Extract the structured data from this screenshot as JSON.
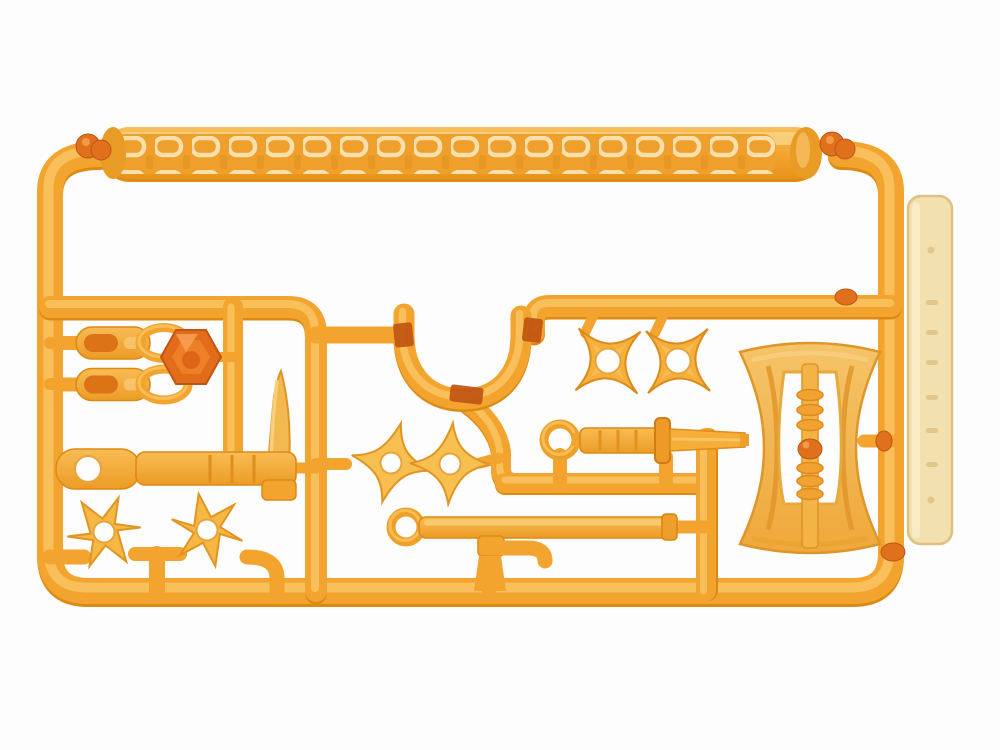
{
  "image": {
    "type": "product-photo",
    "subject": "Injection-molded plastic model runner (sprue) of ninja weapon accessories in translucent orange plastic",
    "orientation": "landscape"
  },
  "labels": {
    "figure": "Translucent orange plastic model kit runner with ninja weapon parts: chain, shuriken stars, sword, sickle, scabbard and a large double-bladed axe"
  },
  "colors": {
    "background": "#fdfdfd",
    "plastic_base": "#F2A42E",
    "plastic_light": "#F9C462",
    "plastic_shadow": "#DD8A14",
    "plastic_deep": "#C05514",
    "gate_knob": "#E0701C",
    "chain_link": "#F8DFAC",
    "chain_lane": "#EE9F2C",
    "part_translucent": "#F3B951",
    "hexagon": "#E36C1A",
    "tag_fill": "#F2E0AE",
    "tag_edge": "#DFC083"
  },
  "parts": [
    {
      "id": "chain-strip",
      "name": "weapon chain",
      "count": 1,
      "position": "top bar of runner"
    },
    {
      "id": "belt-clip",
      "name": "belt clip with oval loop",
      "count": 2,
      "position": "upper left"
    },
    {
      "id": "hex-connector",
      "name": "hexagonal connector gem",
      "count": 1,
      "position": "upper left"
    },
    {
      "id": "kama-sickle",
      "name": "kama sickle with upward blade and ring handle",
      "count": 1,
      "position": "middle left"
    },
    {
      "id": "u-piece",
      "name": "U-shaped curved piece with dark gate bands",
      "count": 1,
      "position": "center"
    },
    {
      "id": "pinwheel-shuriken",
      "name": "four-point pinwheel shuriken",
      "count": 2,
      "position": "center"
    },
    {
      "id": "square-shuriken",
      "name": "square four-point shuriken",
      "count": 2,
      "position": "upper center-right"
    },
    {
      "id": "six-point-shuriken",
      "name": "six-point star shuriken",
      "count": 2,
      "position": "lower left"
    },
    {
      "id": "ring-sword",
      "name": "straight sword with ring pommel and square guard",
      "count": 1,
      "position": "center right"
    },
    {
      "id": "scabbard-rod",
      "name": "long scabbard rod with ring end",
      "count": 1,
      "position": "lower center"
    },
    {
      "id": "pipe-hook",
      "name": "small bent pipe / hook piece",
      "count": 1,
      "position": "lower center"
    },
    {
      "id": "great-axe",
      "name": "large double-bladed axe with ribbed central shaft",
      "count": 1,
      "position": "right"
    },
    {
      "id": "molded-tag",
      "name": "cream molded identification tag",
      "count": 1,
      "position": "far right edge"
    }
  ]
}
